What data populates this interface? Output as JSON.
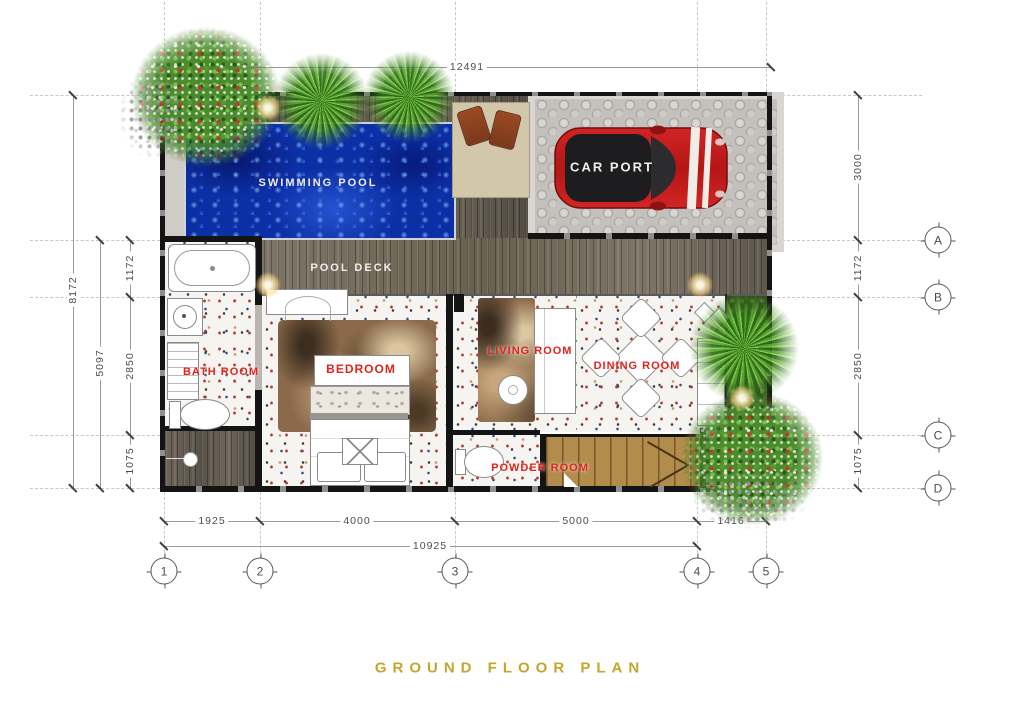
{
  "title": "GROUND FLOOR PLAN",
  "rooms": {
    "swimming_pool": "SWIMMING POOL",
    "pool_deck": "POOL DECK",
    "car_port": "CAR PORT",
    "bath_room": "BATH ROOM",
    "bedroom": "BEDROOM",
    "living_room": "LIVING ROOM",
    "dining_room": "DINING ROOM",
    "powder_room": "POWDER ROOM"
  },
  "dimensions": {
    "top_total": "12491",
    "left_overall": "8172",
    "left_span": "5097",
    "left_ab": "1172",
    "left_bc": "2850",
    "left_cd": "1075",
    "right_top": "3000",
    "right_ab": "1172",
    "right_bc": "2850",
    "right_cd": "1075",
    "bottom_12": "1925",
    "bottom_23": "4000",
    "bottom_34": "5000",
    "bottom_45": "1416",
    "bottom_total": "10925"
  },
  "grid": {
    "row_a": "A",
    "row_b": "B",
    "row_c": "C",
    "row_d": "D",
    "col_1": "1",
    "col_2": "2",
    "col_3": "3",
    "col_4": "4",
    "col_5": "5"
  },
  "colors": {
    "label_red": "#e0241c",
    "title_gold": "#c3a62b",
    "pool_blue": "#0d2fa6",
    "deck_wood": "#6b6257",
    "stair_wood": "#b28c4c",
    "car_red": "#c01f1f"
  }
}
